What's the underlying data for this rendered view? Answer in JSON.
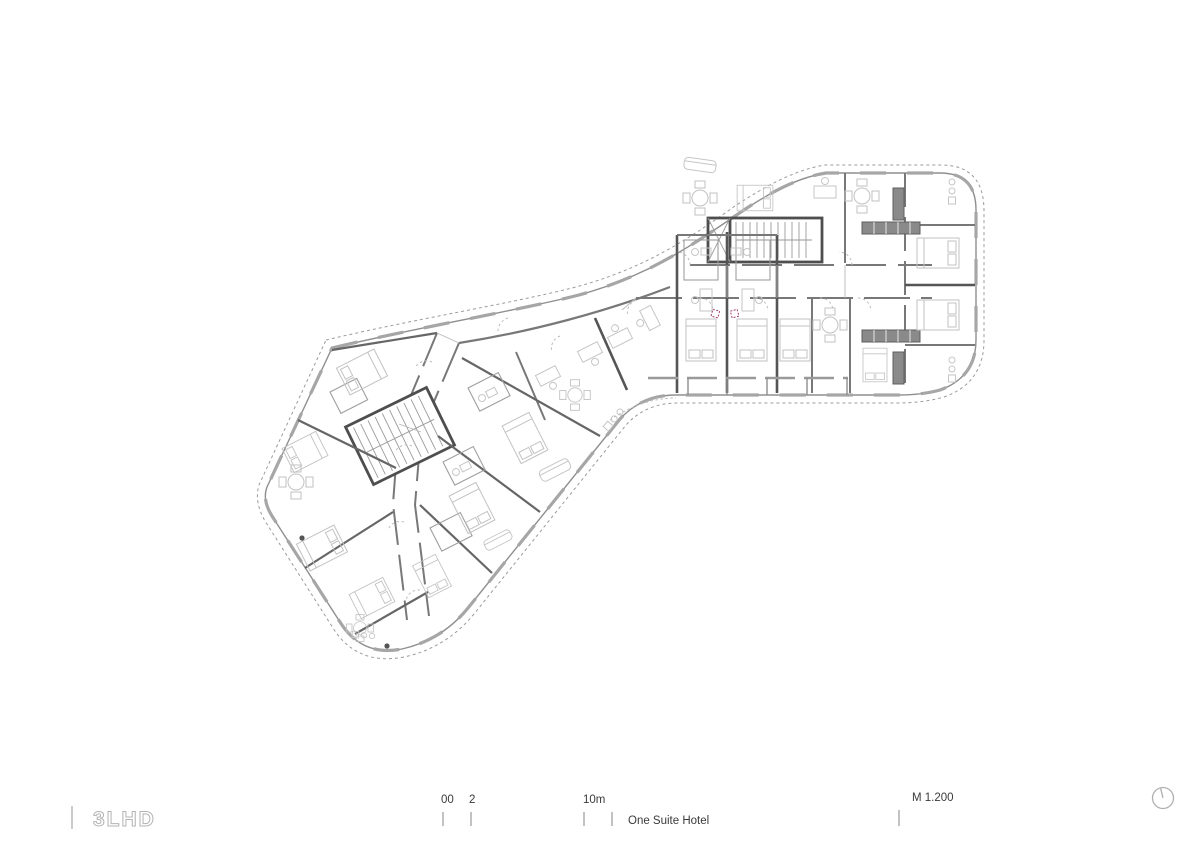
{
  "title_block": {
    "logo_text": "3LHD",
    "project_name": "One Suite Hotel",
    "scale_text": "M 1.200",
    "scale_bar": {
      "label_zero": "00",
      "label_two": "2",
      "label_ten": "10m"
    },
    "north_icon": "north-arrow-icon"
  },
  "drawing": {
    "kind": "hotel floor plan",
    "accent_color": "#a24173",
    "wall_color": "#787878",
    "boundary_color": "#8f8f8f",
    "furniture_color": "#c6c6c6"
  }
}
